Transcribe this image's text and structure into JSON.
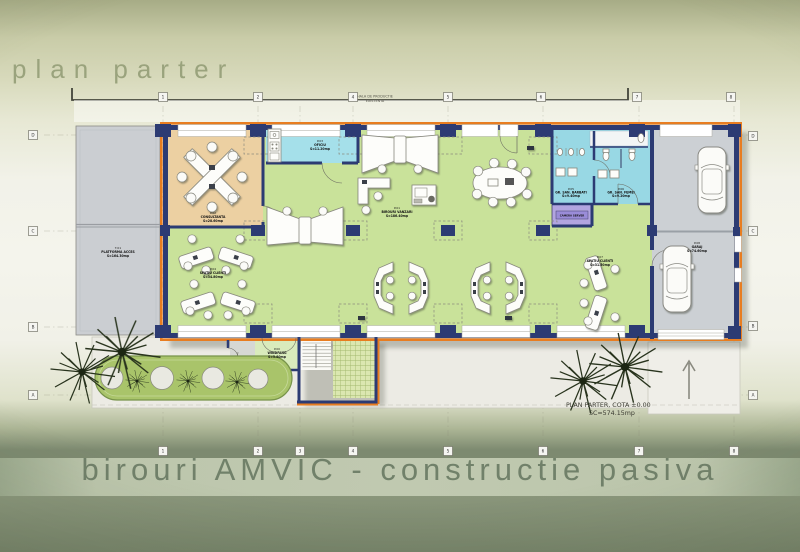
{
  "titles": {
    "top": "plan parter",
    "bottom": "birouri AMVIC - constructie pasiva"
  },
  "caption": {
    "line1": "PLAN PARTER, COTA ±0.00",
    "line2": "SC=574.15mp"
  },
  "site": {
    "hall_line1": "HALA DE PRODUCTIE",
    "hall_line2": "EXISTENTA",
    "platform_id": "T.01",
    "platform_name": "PLATFORMA ACCES",
    "platform_area": "S=164.30mp"
  },
  "grid": {
    "top": [
      "1",
      "2",
      "4",
      "5",
      "6",
      "7",
      "8"
    ],
    "bottom": [
      "1",
      "2",
      "3",
      "4",
      "5",
      "6",
      "7",
      "8"
    ],
    "left": [
      "D",
      "C",
      "B",
      "A"
    ],
    "right": [
      "D",
      "C",
      "B",
      "A"
    ]
  },
  "rooms": {
    "consultanta": {
      "id": "P.02",
      "name": "CONSULTANTA",
      "area": "S=28.60mp"
    },
    "oficiu": {
      "id": "P.03",
      "name": "OFICIU",
      "area": "S=11.20mp"
    },
    "birouri": {
      "id": "P.01",
      "name": "BIROURI VANZARI",
      "area": "S=186.40mp"
    },
    "clienti_st": {
      "id": "P.04",
      "name": "SPATIU CLIENTI",
      "area": "S=34.80mp"
    },
    "clienti_dr": {
      "id": "P.07",
      "name": "SPATIU CLIENTI",
      "area": "S=31.50mp"
    },
    "gs_barbati": {
      "id": "P.05",
      "name": "GR. SAN. BARBATI",
      "area": "S=9.40mp"
    },
    "gs_femei": {
      "id": "P.06",
      "name": "GR. SAN. FEMEI",
      "area": "S=9.20mp"
    },
    "server": {
      "name": "CAMERA SERVER"
    },
    "garaj": {
      "id": "P.08",
      "name": "GARAJ",
      "area": "S=74.60mp"
    },
    "windfang": {
      "id": "P.00",
      "name": "WINDFANG",
      "area": "S=5.80mp"
    }
  },
  "colors": {
    "wall_insulation": "#e87d20",
    "wall_core": "#2c3b73",
    "floor_office": "#c9e29a",
    "floor_conference": "#ecd0a2",
    "floor_wet": "#98d8e4",
    "floor_server": "#b2a5e0",
    "floor_garage": "#ccd0d4",
    "title_text": "#9aa37d"
  }
}
